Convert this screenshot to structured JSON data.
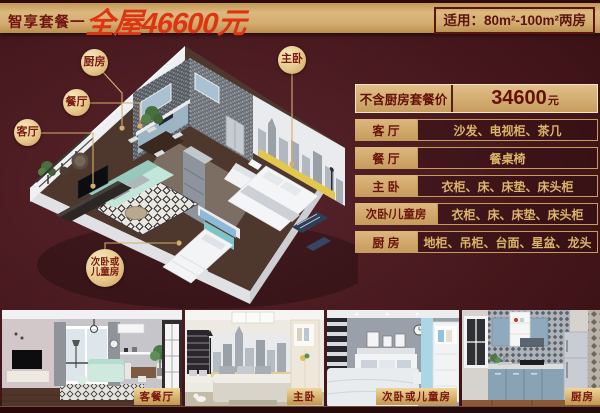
{
  "header": {
    "package_name": "智享套餐一",
    "price_headline": "全屋46600元",
    "applicable": "适用：80m²-100m²两房"
  },
  "price_table": {
    "special": {
      "label": "不含厨房套餐价",
      "price": "34600",
      "unit": "元"
    },
    "rows": [
      {
        "room": "客 厅",
        "items": "沙发、电视柜、茶几"
      },
      {
        "room": "餐 厅",
        "items": "餐桌椅"
      },
      {
        "room": "主 卧",
        "items": "衣柜、床、床垫、床头柜"
      },
      {
        "room": "次卧/儿童房",
        "items": "衣柜、床、床垫、床头柜"
      },
      {
        "room": "厨 房",
        "items": "地柜、吊柜、台面、星盆、龙头"
      }
    ]
  },
  "floorplan": {
    "labels": {
      "kitchen": "厨房",
      "dining": "餐厅",
      "living": "客厅",
      "master": "主卧",
      "second_line1": "次卧或",
      "second_line2": "儿童房"
    }
  },
  "gallery": [
    {
      "caption": "客餐厅"
    },
    {
      "caption": "主卧"
    },
    {
      "caption": "次卧或儿童房"
    },
    {
      "caption": "厨房"
    }
  ],
  "colors": {
    "background": "#46171c",
    "banner_gold": "#d3ad74",
    "headline_red": "#df3412",
    "dark_red_text": "#6d1410",
    "table_gold_text": "#dab469",
    "badge_gold": "#ecd29b",
    "border_cream": "#f3e7cb"
  }
}
